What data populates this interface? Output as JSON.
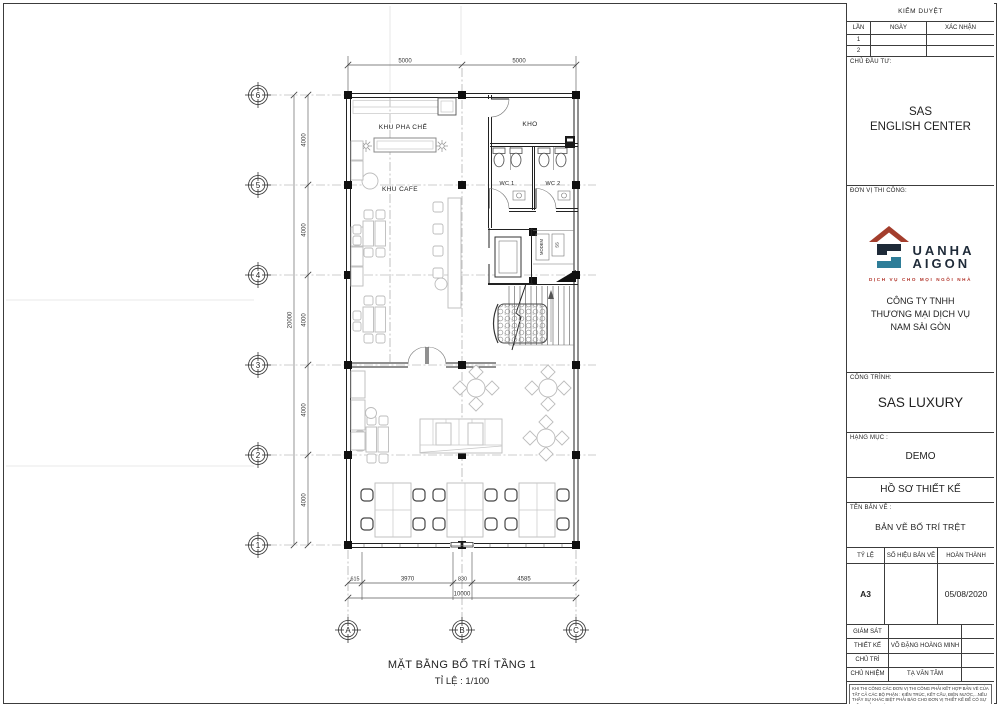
{
  "sheet": {
    "plan_title": "MẶT BẰNG BỐ TRÍ TẦNG 1",
    "plan_scale": "TỈ LỆ : 1/100"
  },
  "plan": {
    "rooms": {
      "khu_pha_che": "KHU PHA CHẾ",
      "kho": "KHO",
      "wc1": "WC 1",
      "wc2": "WC 2",
      "khu_cafe": "KHU CAFE",
      "modem": "MODEM",
      "ss": "SS"
    },
    "dims": {
      "top": [
        "5000",
        "5000"
      ],
      "left": [
        "4000",
        "4000",
        "4000",
        "4000",
        "4000"
      ],
      "left_total": "20000",
      "bottom": [
        "615",
        "3970",
        "830",
        "4585"
      ],
      "bottom_total": "10000"
    },
    "grid": {
      "rows": [
        "6",
        "5",
        "4",
        "3",
        "2",
        "1"
      ],
      "cols": [
        "A",
        "B",
        "C"
      ]
    }
  },
  "title_block": {
    "kiem_duyet": {
      "title": "KIỂM DUYỆT",
      "col_lan": "LẦN",
      "col_ngay": "NGÀY",
      "col_xac_nhan": "XÁC NHẬN",
      "row1": "1",
      "row2": "2"
    },
    "chu_dau_tu": {
      "label": "CHỦ ĐẦU TƯ:",
      "line1": "SAS",
      "line2": "ENGLISH CENTER"
    },
    "don_vi_thi_cong": {
      "label": "ĐƠN VỊ THI CÔNG:",
      "brand_line1": "UANHA",
      "brand_line2": "AIGON",
      "tagline": "DỊCH VỤ CHO MỌI NGÔI NHÀ",
      "company_line1": "CÔNG TY TNHH",
      "company_line2": "THƯƠNG MẠI DỊCH VỤ",
      "company_line3": "NAM SÀI GÒN"
    },
    "cong_trinh": {
      "label": "CÔNG TRÌNH:",
      "value": "SAS LUXURY"
    },
    "hang_muc": {
      "label": "HẠNG MỤC :",
      "value": "DEMO"
    },
    "ho_so_thiet_ke": "HỒ SƠ THIẾT KẾ",
    "ten_ban_ve": {
      "label": "TÊN BẢN VẼ :",
      "value": "BẢN VẼ BỐ TRÍ TRỆT"
    },
    "release": {
      "col_ty_le": "TỶ LỆ",
      "col_so_hieu": "SỐ HIỆU BẢN VẼ",
      "col_hoan_thanh": "HOÀN THÀNH",
      "ty_le": "A3",
      "so_hieu": "",
      "hoan_thanh": "05/08/2020"
    },
    "personnel": [
      {
        "label": "GIÁM SÁT",
        "name": ""
      },
      {
        "label": "THIẾT KẾ",
        "name": "VÕ ĐẶNG HOÀNG MINH"
      },
      {
        "label": "CHỦ TRÌ",
        "name": ""
      },
      {
        "label": "CHỦ NHIỆM",
        "name": "TẠ VĂN TÂM"
      }
    ],
    "note": "KHI THI CÔNG CÁC ĐƠN VỊ THI CÔNG PHẢI KẾT HỢP BẢN VẼ CỦA TẤT CẢ CÁC BỘ PHẬN : KIẾN TRÚC, KẾT CẤU, ĐIỆN NƯỚC,...NẾU THẤY SỰ KHÁC BIỆT PHẢI BÁO CHO ĐƠN VỊ THIẾT KẾ ĐỂ CÓ SỰ ĐIỀU CHỈNH THÍCH HỢP."
  },
  "colors": {
    "logo_roof": "#a33d2c",
    "logo_navy": "#1e2a38",
    "logo_teal": "#2e7d98",
    "logo_tagline": "#b03228",
    "line": "#222222",
    "furniture": "#bcbcbc"
  }
}
